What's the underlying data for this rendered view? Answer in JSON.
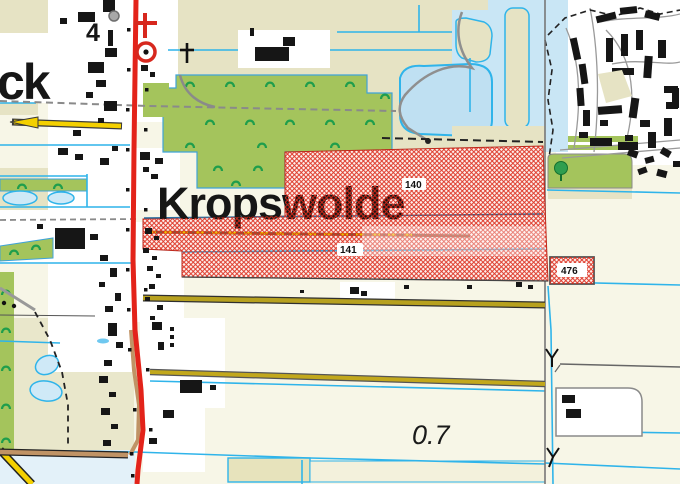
{
  "map": {
    "kind": "topographic-map-extract",
    "labels": {
      "place_main": "Kropswolde",
      "place_partial_left": "ck",
      "road_number": "4",
      "parcel_140": "140",
      "parcel_141": "141",
      "parcel_476": "476",
      "depth_value": "0.7"
    },
    "symbols": [
      "church-with-tower-icon",
      "church-cross-icon",
      "silo-icon",
      "tree-icon",
      "orchard-icon",
      "water-flow-arrow-icon"
    ],
    "colors": {
      "background_cream": "#f7f6e7",
      "field_beige": "#e6e3c4",
      "field_khaki": "#e9e7cb",
      "orchard_green": "#a4c45c",
      "orchard_symbol_green": "#1f9e4c",
      "water_fill": "#c9e6f5",
      "water_line_cyan": "#2fb4ea",
      "road_red": "#e3231a",
      "road_brown": "#c09365",
      "road_olive": "#b7a11f",
      "road_yellow": "#f4d000",
      "hatch_red": "#dc2818",
      "hatch_background": "#fdf2ef",
      "boundary_gray": "#777777",
      "building_black": "#161616"
    }
  }
}
